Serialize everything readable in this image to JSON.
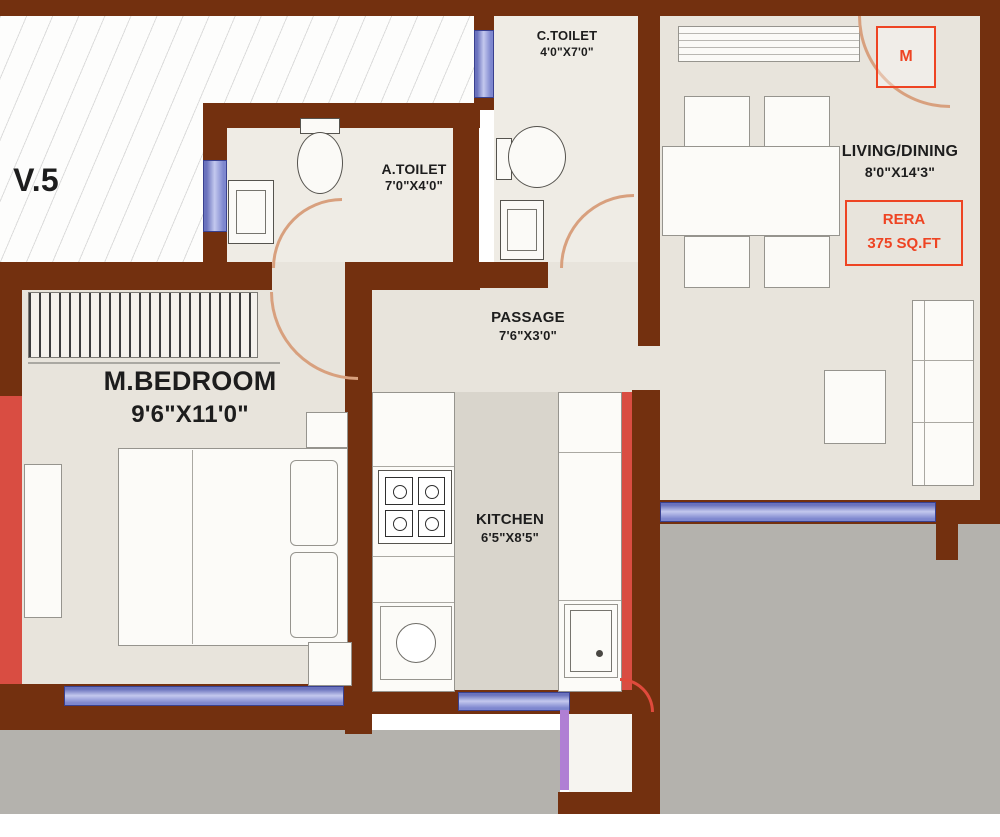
{
  "unit_label": "V.5",
  "entry_marker": "M",
  "rooms": {
    "c_toilet": {
      "name": "C.TOILET",
      "dims": "4'0\"X7'0\""
    },
    "a_toilet": {
      "name": "A.TOILET",
      "dims": "7'0\"X4'0\""
    },
    "living_dining": {
      "name": "LIVING/DINING",
      "dims": "8'0\"X14'3\""
    },
    "passage": {
      "name": "PASSAGE",
      "dims": "7'6\"X3'0\""
    },
    "m_bedroom": {
      "name": "M.BEDROOM",
      "dims": "9'6\"X11'0\""
    },
    "kitchen": {
      "name": "KITCHEN",
      "dims": "6'5\"X8'5\""
    }
  },
  "rera": {
    "line1": "RERA",
    "line2": "375 SQ.FT"
  },
  "colors": {
    "wall": "#73300f",
    "window": "#7e87cf",
    "accent_red": "#ee4423",
    "shaft_red": "#d94d42",
    "floor": "#e8e4dc",
    "exterior_gray": "#b4b2ad",
    "door_arc": "#d8a07e",
    "duct_violet": "#b07fd4"
  }
}
